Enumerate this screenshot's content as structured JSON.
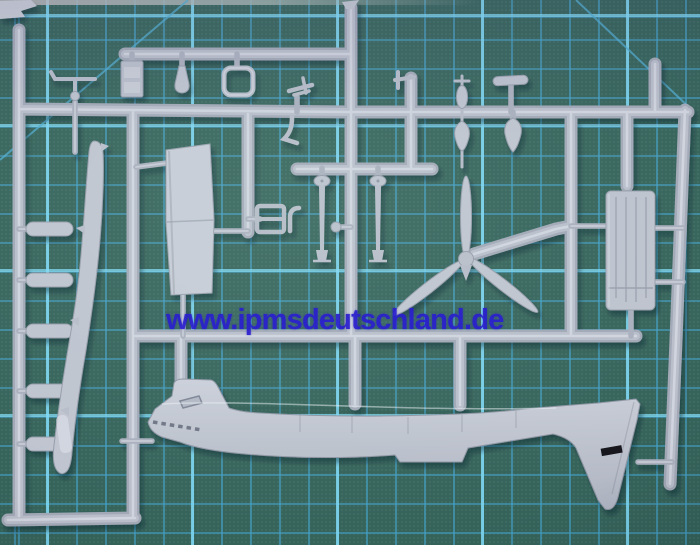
{
  "photo": {
    "type": "photograph",
    "subject": "light grey injection-moulded model aircraft kit sprue lying on a green self-healing cutting mat",
    "watermark": {
      "text": "www.ipmsdeutschland.de",
      "color": "#2a1fce"
    }
  },
  "mat": {
    "description": "dark green cutting mat with printed cyan grid and diagonal guide lines",
    "base_color": "#35635a",
    "grid_minor_color": "#449ec4",
    "grid_major_color": "#80d8f2",
    "grid_cell_px": 29,
    "major_line_every_cells": 5,
    "diagonal_guides": 2
  },
  "sprue": {
    "plastic_color": "#b4b9c5",
    "highlight_color": "#d6dae2",
    "parts": [
      {
        "name": "fuselage-half",
        "desc": "aircraft fuselage half with cockpit canopy, exhaust row on nose and down-swept tail fin"
      },
      {
        "name": "tail-fin-marking",
        "desc": "small black rectangular marking on tail fin",
        "color": "#16161c"
      },
      {
        "name": "propeller",
        "desc": "three-blade propeller with hub and small spinner cone"
      },
      {
        "name": "wing-panel",
        "desc": "flat tapered wing panel with spanwise seam"
      },
      {
        "name": "outer-wing-blade",
        "desc": "long curved outer wing / blade part"
      },
      {
        "name": "bombs",
        "desc": "small bomb / tank bodies on ladder rungs at left",
        "count": 5
      },
      {
        "name": "instrument-box",
        "desc": "rectangular instrument-panel block"
      },
      {
        "name": "exhaust-bell",
        "desc": "bell-shaped exhaust / cylinder part"
      },
      {
        "name": "windscreen-frame",
        "desc": "open rounded rectangular windscreen frame"
      },
      {
        "name": "landing-gear-struts",
        "desc": "two gear legs with oval cover plates and flared feet",
        "count": 2
      },
      {
        "name": "radiator-block",
        "desc": "ribbed rectangular radiator panel at right"
      },
      {
        "name": "finned-bomb-and-tank",
        "desc": "small finned bomb above rail and teardrop tank below"
      },
      {
        "name": "spinner-teardrop",
        "desc": "teardrop spinner cone hanging from top rail"
      },
      {
        "name": "tailplane-strip",
        "desc": "small horizontal stabilizer strip"
      },
      {
        "name": "aerial-mast",
        "desc": "T-shaped aerial mast with ball joint"
      },
      {
        "name": "bulkhead-frame",
        "desc": "small H-shaped bulkhead frame with curved bracket"
      },
      {
        "name": "control-arm",
        "desc": "small bent control arm"
      },
      {
        "name": "ball-knob",
        "desc": "small ball-ended pin"
      }
    ]
  }
}
